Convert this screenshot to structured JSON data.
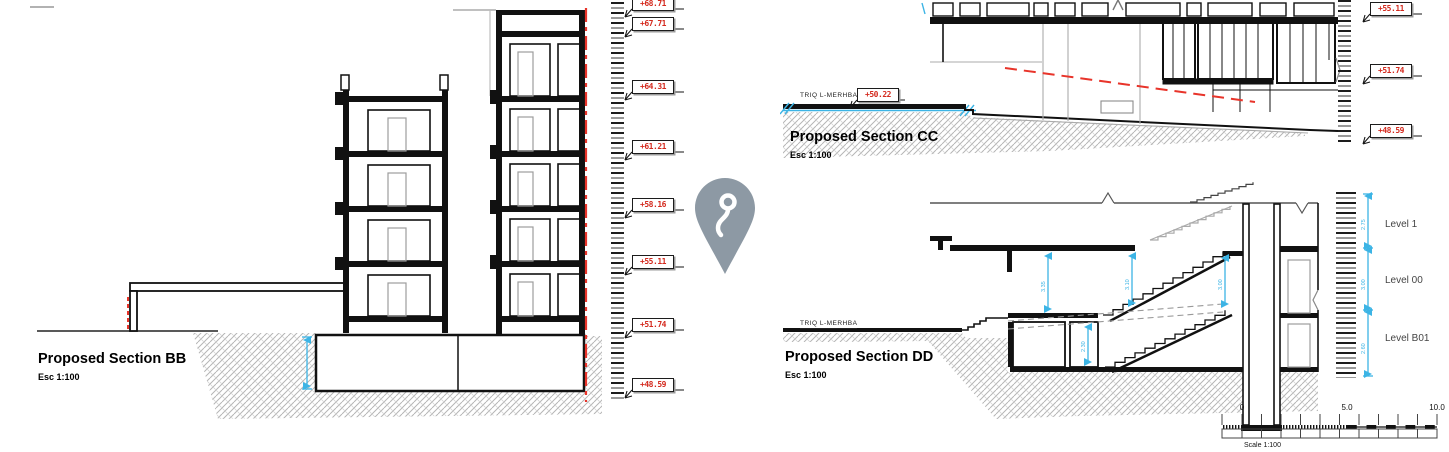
{
  "sections": {
    "bb": {
      "title": "Proposed Section BB",
      "scale_label": "Esc 1:100"
    },
    "cc": {
      "title": "Proposed Section CC",
      "scale_label": "Esc 1:100",
      "street_label": "TRIQ L-MERHBA",
      "street_elevation": "+50.22"
    },
    "dd": {
      "title": "Proposed Section DD",
      "scale_label": "Esc 1:100",
      "street_label": "TRIQ L-MERHBA",
      "levels": [
        {
          "label": "Level 1",
          "height": "2.75"
        },
        {
          "label": "Level 00",
          "height": "3.00"
        },
        {
          "label": "Level B01",
          "height": "2.60"
        }
      ],
      "stair_dimensions": [
        "3.35",
        "3.10",
        "3.00",
        "2.30"
      ]
    }
  },
  "elevation_markers_left": [
    "+68.71",
    "+67.71",
    "+64.31",
    "+61.21",
    "+58.16",
    "+55.11",
    "+51.74",
    "+48.59"
  ],
  "elevation_markers_right": [
    "+55.11",
    "+51.74",
    "+48.59"
  ],
  "scale_bar": {
    "tick_labels": [
      "0",
      "5.0",
      "10.0"
    ],
    "caption": "Scale 1:100"
  },
  "icons": {
    "pin": "location-pin"
  },
  "colors": {
    "elevation_red": "#d42a1e",
    "dimension_cyan": "#3cb4e5",
    "section_cut_red": "#e8342a",
    "pin_gray": "#8d99a4",
    "hatch_gray": "#b5b5b5"
  }
}
